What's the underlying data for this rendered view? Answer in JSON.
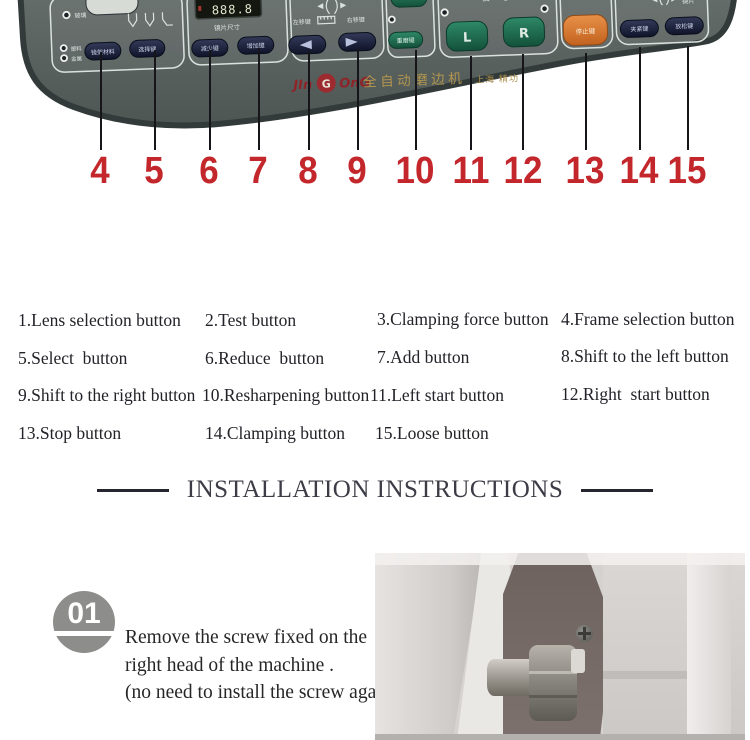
{
  "panel": {
    "brand": {
      "logo_prefix": "JIn",
      "logo_letter": "G",
      "logo_suffix": "OnG",
      "machine_name": "全自动磨边机",
      "maker": "上海 精功"
    },
    "lens_size": {
      "display_value": "888.8",
      "label": "镜片尺寸"
    },
    "materials": {
      "glass": "玻璃",
      "plastic": "塑料",
      "metal": "金属",
      "frame_material_btn": "镜架材料",
      "select_btn": "选择键"
    },
    "size_keys": {
      "reduce_btn": "减少键",
      "add_btn": "增加键"
    },
    "shift": {
      "left_label": "左移键",
      "right_label": "右移键"
    },
    "regrind_btn": "重磨键",
    "start": {
      "label": "启 动",
      "left_btn": "L",
      "right_btn": "R"
    },
    "stop_btn": "停止键",
    "clamp": {
      "indicator_label": "夹",
      "lens_label": "镜片",
      "clamp_btn": "夹紧键",
      "loosen_btn": "放松键"
    }
  },
  "callouts": {
    "numbers": [
      "4",
      "5",
      "6",
      "7",
      "8",
      "9",
      "10",
      "11",
      "12",
      "13",
      "14",
      "15"
    ]
  },
  "legend": {
    "items": [
      "1.Lens selection button",
      "2.Test button",
      "3.Clamping force button",
      "4.Frame selection button",
      "5.Select  button",
      "6.Reduce  button",
      "7.Add button",
      "8.Shift to the left button",
      "9.Shift to the right button",
      "10.Resharpening button",
      "11.Left start button",
      "12.Right  start button",
      "13.Stop button",
      "14.Clamping button",
      "15.Loose button"
    ]
  },
  "installation": {
    "title": "INSTALLATION INSTRUCTIONS"
  },
  "step1": {
    "number": "01",
    "line1": "Remove the screw fixed on the",
    "line2": "right head of the machine .",
    "line3": "(no need to install the screw again)."
  },
  "colors": {
    "accent_red": "#c3272c",
    "panel_navy": "#1d2338",
    "panel_green": "#1f7257",
    "panel_orange": "#d97b33",
    "brand_gold": "#b2954d"
  }
}
